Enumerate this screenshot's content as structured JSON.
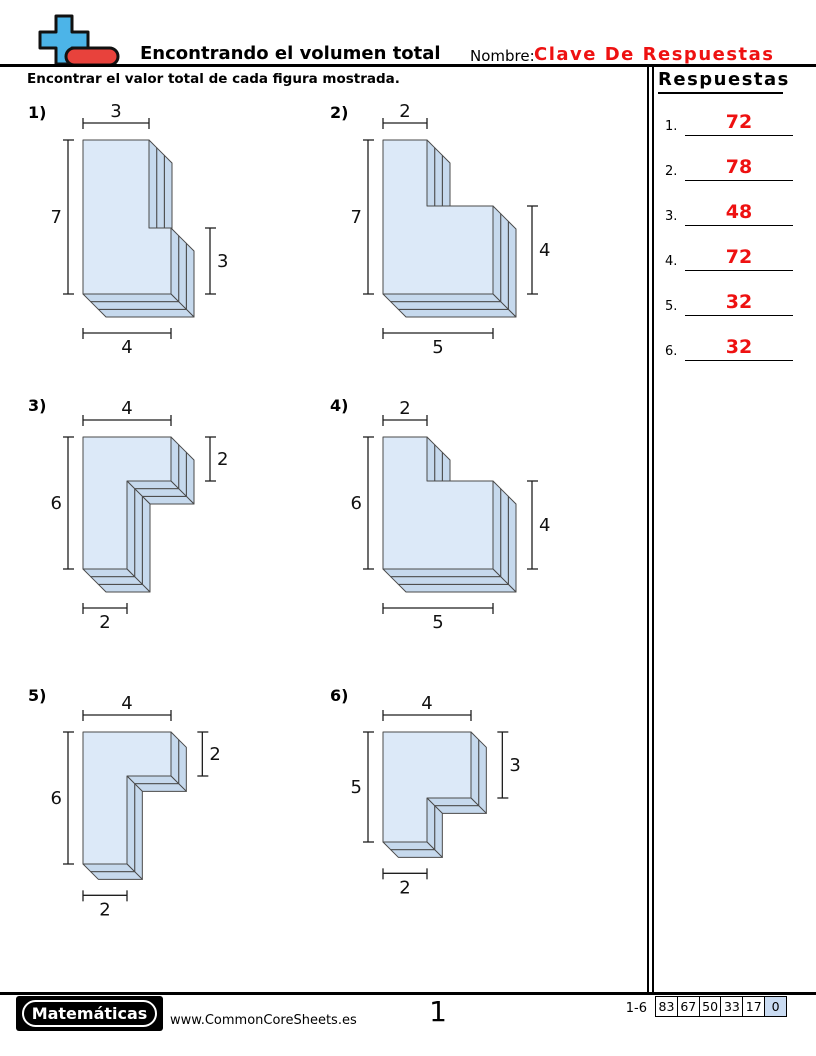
{
  "header": {
    "title": "Encontrando el volumen total",
    "name_label": "Nombre:",
    "name_value": "Clave De Respuestas",
    "logo": "plus-minus-logo"
  },
  "instruction": "Encontrar el valor total de cada figura mostrada.",
  "answers": {
    "title": "Respuestas",
    "items": [
      {
        "num": "1.",
        "value": "72"
      },
      {
        "num": "2.",
        "value": "78"
      },
      {
        "num": "3.",
        "value": "48"
      },
      {
        "num": "4.",
        "value": "72"
      },
      {
        "num": "5.",
        "value": "32"
      },
      {
        "num": "6.",
        "value": "32"
      }
    ]
  },
  "figures": [
    {
      "label": "1)",
      "shape": {
        "type": "A",
        "w_top": 3,
        "h_left": 7,
        "h_right": 3,
        "w_bottom": 4,
        "depth": 3
      },
      "dims": {
        "top": "3",
        "left": "7",
        "right": "3",
        "bottom": "4"
      },
      "cell": {
        "x": 28,
        "y": 101
      },
      "origin": {
        "x": 55,
        "y": 39
      }
    },
    {
      "label": "2)",
      "shape": {
        "type": "A",
        "w_top": 2,
        "h_left": 7,
        "h_right": 4,
        "w_bottom": 5,
        "depth": 3
      },
      "dims": {
        "top": "2",
        "left": "7",
        "right": "4",
        "bottom": "5"
      },
      "cell": {
        "x": 330,
        "y": 101
      },
      "origin": {
        "x": 53,
        "y": 39
      }
    },
    {
      "label": "3)",
      "shape": {
        "type": "B",
        "w_top": 4,
        "h_left": 6,
        "h_right": 2,
        "w_bottom": 2,
        "depth": 3
      },
      "dims": {
        "top": "4",
        "left": "6",
        "right": "2",
        "bottom": "2"
      },
      "cell": {
        "x": 28,
        "y": 394
      },
      "origin": {
        "x": 55,
        "y": 43
      }
    },
    {
      "label": "4)",
      "shape": {
        "type": "A",
        "w_top": 2,
        "h_left": 6,
        "h_right": 4,
        "w_bottom": 5,
        "depth": 3
      },
      "dims": {
        "top": "2",
        "left": "6",
        "right": "4",
        "bottom": "5"
      },
      "cell": {
        "x": 330,
        "y": 394
      },
      "origin": {
        "x": 53,
        "y": 43
      }
    },
    {
      "label": "5)",
      "shape": {
        "type": "B",
        "w_top": 4,
        "h_left": 6,
        "h_right": 2,
        "w_bottom": 2,
        "depth": 2
      },
      "dims": {
        "top": "4",
        "left": "6",
        "right": "2",
        "bottom": "2"
      },
      "cell": {
        "x": 28,
        "y": 684
      },
      "origin": {
        "x": 55,
        "y": 48
      }
    },
    {
      "label": "6)",
      "shape": {
        "type": "B",
        "w_top": 4,
        "h_left": 5,
        "h_right": 3,
        "w_bottom": 2,
        "depth": 2
      },
      "dims": {
        "top": "4",
        "left": "5",
        "right": "3",
        "bottom": "2"
      },
      "cell": {
        "x": 330,
        "y": 684
      },
      "origin": {
        "x": 53,
        "y": 48
      }
    }
  ],
  "footer": {
    "brand": "Matemáticas",
    "website": "www.CommonCoreSheets.es",
    "page": "1",
    "score_range": "1-6",
    "score_cells": [
      "83",
      "67",
      "50",
      "33",
      "17",
      "0"
    ]
  },
  "colors": {
    "face": "#dce9f8",
    "side": "#c6d9ed",
    "edge": "#4a4a4a",
    "dim_line": "#1f1f1f",
    "answer_red": "#ee1111",
    "logo_blue": "#4cb4e8",
    "logo_red": "#e8423c",
    "score_cell_bg": "#c9dbf2"
  }
}
